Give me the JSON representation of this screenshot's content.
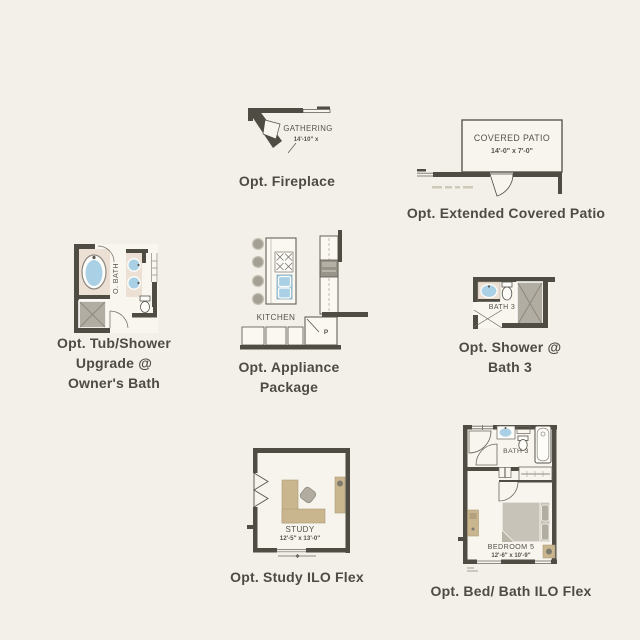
{
  "canvas": {
    "background": "#f2f0e9",
    "wall_color": "#4f4c44",
    "caption_color": "#4e4b43",
    "water_blue": "#a9d0e5",
    "counter_beige": "#ecdfd3",
    "furniture_tan": "#c9b68f",
    "shower_gray": "#b2ada2"
  },
  "options": {
    "fireplace": {
      "caption": "Opt. Fireplace",
      "room": "GATHERING",
      "dims": "14'-10\" x"
    },
    "patio": {
      "caption": "Opt. Extended Covered Patio",
      "room": "COVERED PATIO",
      "dims": "14'-0\" x 7'-0\""
    },
    "owners_bath": {
      "caption_lines": [
        "Opt. Tub/Shower",
        "Upgrade @",
        "Owner's Bath"
      ],
      "room": "O. BATH"
    },
    "appliance": {
      "caption_lines": [
        "Opt. Appliance",
        "Package"
      ],
      "room": "KITCHEN",
      "pantry": "P"
    },
    "shower_bath3": {
      "caption_lines": [
        "Opt. Shower @",
        "Bath 3"
      ],
      "room": "BATH 3"
    },
    "study": {
      "caption": "Opt. Study ILO Flex",
      "room": "STUDY",
      "dims": "12'-5\" x 13'-0\""
    },
    "bed_bath": {
      "caption": "Opt. Bed/ Bath ILO Flex",
      "bath_room": "BATH 3",
      "bedroom_room": "BEDROOM 5",
      "bedroom_dims": "12'-6\" x 10'-9\""
    }
  }
}
